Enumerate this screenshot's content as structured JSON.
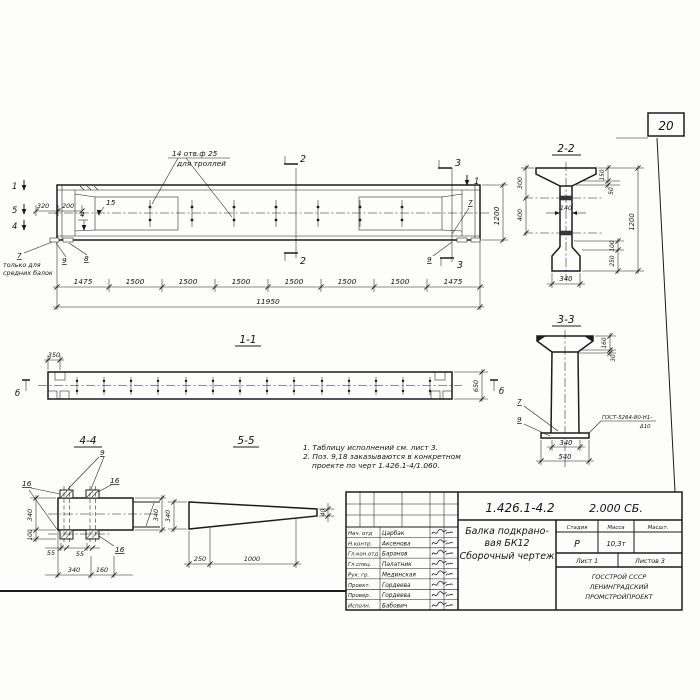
{
  "sheet": {
    "page_number": "20"
  },
  "elevation": {
    "holes_note_line1": "14 отв.ф 25",
    "holes_note_line2": "для троллей",
    "only_note_line1": "только для",
    "only_note_line2": "средних балок",
    "marks": {
      "m1l": "1",
      "m5l": "5",
      "m4l": "4",
      "m2t": "2",
      "m2b": "2",
      "m3t": "3",
      "m3b": "3",
      "m1r": "1"
    },
    "pos": {
      "p15": "15",
      "p4": "4",
      "p7l": "7",
      "p9l": "9",
      "p8l": "8",
      "p7r": "7",
      "p9r": "9"
    },
    "dims": {
      "d320": "320",
      "d200": "200",
      "d1200": "1200",
      "total": "11950",
      "segments": [
        "1475",
        "1500",
        "1500",
        "1500",
        "1500",
        "1500",
        "1500",
        "1475"
      ]
    }
  },
  "section22": {
    "title": "2-2",
    "dims": {
      "d300": "300",
      "d400": "400",
      "d150": "150",
      "d50": "50",
      "d140": "140",
      "d100": "100",
      "d250": "250",
      "d1200": "1200",
      "d340": "340"
    }
  },
  "section33": {
    "title": "3-3",
    "pos": {
      "p7": "7",
      "p9": "9"
    },
    "weld_line1": "ГОСТ-5264-80-Н1-",
    "weld_line2": "Δ10",
    "dims": {
      "d160": "160",
      "d30": "30",
      "d340": "340",
      "d540": "540"
    }
  },
  "view11": {
    "title": "1-1",
    "marks": {
      "left": "б",
      "right": "б"
    },
    "dims": {
      "d350": "350",
      "d650": "650"
    }
  },
  "view44": {
    "title": "4-4",
    "pos": {
      "p9": "9",
      "p16a": "16",
      "p16b": "16",
      "p16c": "16"
    },
    "dims": {
      "d340l": "340",
      "d100": "100",
      "d55a": "55",
      "d55b": "55",
      "d340b": "340",
      "d160": "160",
      "d340r": "340"
    }
  },
  "view55": {
    "title": "5-5",
    "dims": {
      "d340": "340",
      "d40": "40",
      "d250": "250",
      "d1000": "1000"
    }
  },
  "notes": {
    "line1": "1. Таблицу исполнений см. лист 3.",
    "line2": "2. Поз. 9,18 заказываются в конкретном",
    "line3": "проекте по черт 1.426.1-4/1.060."
  },
  "titleblock": {
    "doc_number": "1.426.1-4.2",
    "doc_code": "2.000 СБ.",
    "product_line1": "Балка подкрано-",
    "product_line2": "вая  БК12",
    "product_line3": "Сборочный  чертеж",
    "headers": {
      "stage": "Стадия",
      "mass": "Масса",
      "scale": "Масшт."
    },
    "values": {
      "stage": "Р",
      "mass": "10,3т"
    },
    "sheet_info": {
      "sheet": "Лист 1",
      "sheets": "Листов 3"
    },
    "org_line1": "ГОССТРОЙ СССР",
    "org_line2": "ЛЕНИНГРАДСКИЙ",
    "org_line3": "ПРОМСТРОЙПРОЕКТ",
    "signers": [
      {
        "role": "Нач. отд",
        "name": "Царбак"
      },
      {
        "role": "Н.контр.",
        "name": "Аксенова"
      },
      {
        "role": "Гл.кон.отд",
        "name": "Баранов"
      },
      {
        "role": "Гл.спец.",
        "name": "Палатник"
      },
      {
        "role": "Рук. гр.",
        "name": "Мединская"
      },
      {
        "role": "Проект.",
        "name": "Гордеева"
      },
      {
        "role": "Провер.",
        "name": "Гордеева"
      },
      {
        "role": "Исполн.",
        "name": "Бабович"
      }
    ]
  }
}
